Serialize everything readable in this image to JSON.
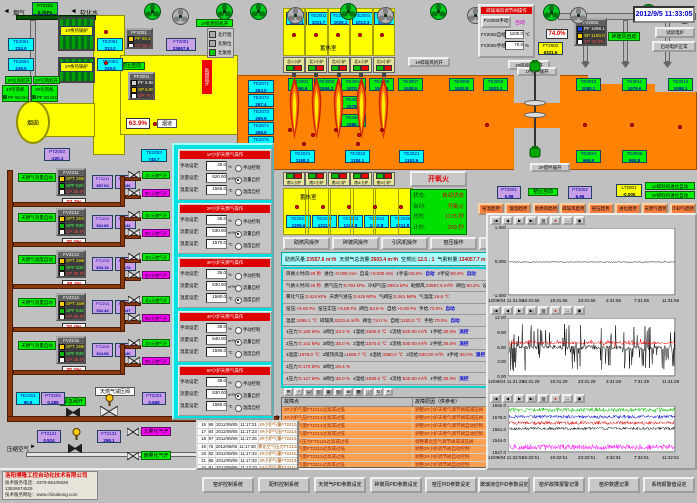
{
  "header": {
    "datetime": "2012/9/5 11:33:05"
  },
  "labels": {
    "flue_gas": "烟气",
    "soft_water": "软化水",
    "chimney": "烟囱",
    "flue": "烟道",
    "comb_air_on": "助燃风开",
    "comb_fan1_on": "1#助燃风机开",
    "idf1_on": "1#引风机开",
    "idf2_on": "2#引风机开",
    "idf1": "1#引风机",
    "idf2": "2#引风机",
    "idf_freq": "PF 50.0Hz",
    "hx1": "1#余热锅炉",
    "hx2": "2#余热锅炉",
    "kiln_auto1": "窑压自动",
    "kiln_auto2": "窑压自动",
    "glass_fan_auto": "碎玻风自动",
    "glass_fan1_on": "1#碎玻风机开",
    "glass_fan2_on": "2#碎玻风机开",
    "stir1_on": "1#搅拌器开",
    "stir2_on": "2#搅拌器开",
    "feeder1_auto": "1#碎料机进位自动",
    "feeder2_auto": "2#碎料机进位自动",
    "test_furnace": "试验电炉",
    "heater_ok": "启动电炉正常",
    "emerg_valve": "紧急阀开",
    "gas_reducer": "天燃气减压阀",
    "comp_air": "压缩空气",
    "atom_north": "北雾化气开",
    "atom_south": "南雾化气开",
    "valve_main": "63.9%",
    "valve_crusher": "74.0%"
  },
  "legend": {
    "items": [
      "北行程",
      "北限位",
      "北氧枪"
    ]
  },
  "furnace": {
    "regen_north": "蓄热室",
    "regen_south": "蓄热室",
    "north_boxes": [
      "北1小炉",
      "北2小炉",
      "北3小炉",
      "北4小炉",
      "北5小炉"
    ],
    "south_boxes": [
      "南1小炉",
      "南2小炉",
      "南3小炉",
      "南4小炉",
      "南5小炉"
    ]
  },
  "sensors": [
    {
      "id": "PT2202",
      "v": "0.7kPa"
    },
    {
      "id": "TE2061",
      "v": "234.0"
    },
    {
      "id": "TE2064",
      "v": "239.0"
    },
    {
      "id": "TE2081",
      "v": "313.0"
    },
    {
      "id": "TE2063",
      "v": "319.0"
    },
    {
      "id": "PT2003",
      "v": "-220.1"
    },
    {
      "id": "TE2053",
      "v": "745.7"
    },
    {
      "id": "FT2001",
      "v": "23657.6"
    },
    {
      "id": "TE2001",
      "v": "1090.1"
    },
    {
      "id": "TE2002",
      "v": "1011.7"
    },
    {
      "id": "TE2003",
      "v": "1025.1"
    },
    {
      "id": "TE2004",
      "v": "1013.3"
    },
    {
      "id": "TE2005",
      "v": "1061.7"
    },
    {
      "id": "TE2071",
      "v": "263.0"
    },
    {
      "id": "TE2072",
      "v": "267.4"
    },
    {
      "id": "TE2073",
      "v": "269.6"
    },
    {
      "id": "TE2074",
      "v": "268.6"
    },
    {
      "id": "TE2075",
      "v": "266.8"
    },
    {
      "id": "TE3001",
      "v": "1550.8"
    },
    {
      "id": "TE3002",
      "v": "1506.2"
    },
    {
      "id": "TE3004",
      "v": "1570.9"
    },
    {
      "id": "TE3022",
      "v": "1578.8"
    },
    {
      "id": "TE3005",
      "v": "1586.7"
    },
    {
      "id": "TE3006",
      "v": "1567.5"
    },
    {
      "id": "TE3007",
      "v": "1538.5"
    },
    {
      "id": "TE3008",
      "v": "1533.8"
    },
    {
      "id": "TE3009",
      "v": "1523.1"
    },
    {
      "id": "TE3010",
      "v": "1080.1"
    },
    {
      "id": "TE3011",
      "v": "1079.6"
    },
    {
      "id": "TE3012",
      "v": "1098.1"
    },
    {
      "id": "TE2021",
      "v": "1168.3"
    },
    {
      "id": "TE3023",
      "v": "1184.1"
    },
    {
      "id": "TE3021",
      "v": "1153.9"
    },
    {
      "id": "TE3024",
      "v": "965.9"
    },
    {
      "id": "TE3025",
      "v": "965.8"
    },
    {
      "id": "TE2041",
      "v": "1209.6"
    },
    {
      "id": "TE2042",
      "v": "1211.0"
    },
    {
      "id": "TE2043",
      "v": "1224.8"
    },
    {
      "id": "TE2044",
      "v": "1212.8"
    },
    {
      "id": "TE2045",
      "v": "1211.8"
    },
    {
      "id": "PT2001",
      "v": "5.88"
    },
    {
      "id": "PT2002",
      "v": "6.96"
    },
    {
      "id": "LT2001",
      "v": "-0.005"
    },
    {
      "id": "FT2002",
      "v": "6331.6"
    },
    {
      "id": "TE2201",
      "v": "90.6"
    },
    {
      "id": "PT2202",
      "v": "0.285"
    },
    {
      "id": "FT2201",
      "v": "0.659"
    },
    {
      "id": "FT2121",
      "v": "0.524"
    },
    {
      "id": "FT2131",
      "v": "298.1"
    }
  ],
  "controllers": {
    "fan": {
      "title": "PF2001",
      "rows": [
        {
          "k": "PF",
          "v": "60.2%"
        },
        {
          "k": "CP",
          "v": "60.1%"
        }
      ]
    },
    "kiln": {
      "title": "PF2001",
      "rows": [
        {
          "k": "PF",
          "v": "5.88"
        },
        {
          "k": "SP",
          "v": "6.00"
        },
        {
          "k": "OP",
          "v": "78.0%"
        }
      ]
    },
    "crusher": {
      "title": "FV2002",
      "rows": [
        {
          "k": "PF",
          "v": "1098.1"
        },
        {
          "k": "SP",
          "v": "1100.0"
        },
        {
          "k": "CP",
          "v": "70.0%"
        }
      ]
    }
  },
  "gas_lines": [
    {
      "fv": "FV2211",
      "auto": "天燃气流量自动",
      "spt": "1560.0",
      "spf": "520.00",
      "cp": "30.0%",
      "ftq_id": "FT2211",
      "ftq": "557.04",
      "ftp_id": "FT2231",
      "ftp": "0.136",
      "valve": "33.3%",
      "north": "北1天燃气开",
      "south": "南1天燃气开"
    },
    {
      "fv": "FV2212",
      "auto": "天燃气流量自动",
      "spt": "1570.0",
      "spf": "530.00",
      "cp": "35.0%",
      "ftq_id": "FT2212",
      "ftq": "522.89",
      "ftp_id": "FT2232",
      "ftp": "0.142",
      "valve": "35.0%",
      "north": "北2天燃气开",
      "south": "南2天燃气开"
    },
    {
      "fv": "FV2213",
      "auto": "天燃气温度自动",
      "spt": "1580.0",
      "spf": "530.00",
      "cp": "35.0%",
      "ftq_id": "FT2213",
      "ftq": "603.19",
      "ftp_id": "FT2233",
      "ftp": "0.178",
      "valve": "48.4%",
      "north": "北3天燃气开",
      "south": "南3天燃气开"
    },
    {
      "fv": "FV2214",
      "auto": "天燃气流量自动",
      "spt": "1590.0",
      "spf": "540.00",
      "cp": "30.0%",
      "ftq_id": "FT2214",
      "ftq": "532.44",
      "ftp_id": "FT2234",
      "ftp": "0.147",
      "valve": "36.0%",
      "north": "北4天燃气开",
      "south": "南4天燃气开"
    },
    {
      "fv": "FV2215",
      "auto": "天燃气流量自动",
      "spt": "1580.0",
      "spf": "530.00",
      "cp": "35.0%",
      "ftq_id": "FT2215",
      "ftq": "524.58",
      "ftp_id": "FT2235",
      "ftp": "0.140",
      "valve": "35.0%",
      "north": "北5天燃气开",
      "south": "南5天燃气开"
    }
  ],
  "popup": {
    "field_labels": [
      "手动设定:",
      "流量设定:",
      "温度设定:"
    ],
    "units": [
      "%",
      "m³/h",
      "℃"
    ],
    "radios": [
      "手动控制",
      "流量自控",
      "温度自控"
    ],
    "panels": [
      {
        "title": "1#小炉天燃气操作",
        "values": [
          "30.0",
          "520.00",
          "1560.0"
        ],
        "selected": 1
      },
      {
        "title": "2#小炉天燃气操作",
        "values": [
          "35.0",
          "530.00",
          "1570.0"
        ],
        "selected": 1
      },
      {
        "title": "3#小炉天燃气操作",
        "values": [
          "35.0",
          "530.00",
          "1580.0"
        ],
        "selected": 2
      },
      {
        "title": "4#小炉天燃气操作",
        "values": [
          "30.0",
          "540.00",
          "1590.0"
        ],
        "selected": 1
      },
      {
        "title": "5#小炉天燃气操作",
        "values": [
          "35.0",
          "530.00",
          "1580.0"
        ],
        "selected": 1
      }
    ]
  },
  "dialog": {
    "title": "碎玻璃风调节阀操作",
    "manual_btn": "FV2002手动",
    "auto_label": "自动",
    "rows": [
      {
        "l": "FV2002自给",
        "v": "1100.0",
        "u": "℃"
      },
      {
        "l": "FV2002手给",
        "v": "70.0",
        "u": "%"
      }
    ]
  },
  "status_panel": {
    "fire_btn": "开氧火",
    "rows": [
      {
        "l": "状态:",
        "v": "自动状态"
      },
      {
        "l": "自动:",
        "v": "开氧火"
      },
      {
        "l": "总时:",
        "v": "1175 秒"
      },
      {
        "l": "计时:",
        "v": "269 秒"
      }
    ]
  },
  "op_buttons": [
    "助燃风操作",
    "碎玻风操作",
    "引风机操作",
    "窑压操作",
    "进位操作",
    "天燃气操作"
  ],
  "trend_buttons": [
    "窑温趋势",
    "烟温趋势",
    "助燃风趋势",
    "碎玻风趋势",
    "窑压趋势",
    "进位趋势",
    "天燃气趋势",
    "冷却气趋势"
  ],
  "summary": [
    {
      "l": "助燃风量:",
      "v": "23557.6 m³/h"
    },
    {
      "l": "天燃气总流量:",
      "v": "2603.4 m³/h"
    },
    {
      "l": "空燃比:",
      "v": "12.5 : 1"
    },
    {
      "l": "气累积量:",
      "v": "134057.7 m³"
    }
  ],
  "param_rows": [
    [
      {
        "l": "风换火时间:",
        "v": "25 秒"
      },
      {
        "l": "进位:",
        "v": "-0.005 mm"
      },
      {
        "l": "自设:",
        "v": "+0.000 mm"
      },
      {
        "l": "1手设:",
        "v": "50.0%"
      },
      {
        "tag": "自动"
      },
      {
        "l": "2手设:",
        "v": "50.0%"
      },
      {
        "tag": "自动"
      }
    ],
    [
      {
        "l": "气换火时间:",
        "v": "25 秒"
      },
      {
        "l": "燃气压力:",
        "v": "0.794 kPa"
      },
      {
        "l": "冷却气压:",
        "v": "298.5 kPa"
      },
      {
        "l": "助燃风:",
        "v": "23557.6 m³/h"
      },
      {
        "l": "阀位:",
        "v": "60.2%"
      },
      {
        "l": "设定:",
        "v": "60.0%"
      }
    ],
    [
      {
        "l": "雾化气压:",
        "v": "0.524 kPa"
      },
      {
        "l": "天燃气进压:",
        "v": "0.619 MPa"
      },
      {
        "l": "气阀压:",
        "v": "0.261 MPa"
      },
      {
        "l": "气温度:",
        "v": "19.6 ℃"
      }
    ],
    [
      {
        "l": "窑压:",
        "v": "+6.00 Pa"
      },
      {
        "l": "窑压实压:",
        "v": "+5.88 Pa"
      },
      {
        "l": "阀位:",
        "v": "63.9 %"
      },
      {
        "l": "自给:",
        "v": "+6.00 Pa"
      },
      {
        "l": "手给:",
        "v": "70.0%"
      },
      {
        "tag": "自动"
      }
    ],
    [
      {
        "l": "温度:",
        "v": "1098.1 ℃"
      },
      {
        "l": "碎玻风:",
        "v": "6331.6 m³/h"
      },
      {
        "l": "阀位:",
        "v": "74.0 %"
      },
      {
        "l": "自给:",
        "v": "1100.0 ℃"
      },
      {
        "l": "手给:",
        "v": "70.0%"
      },
      {
        "tag": "自动"
      }
    ],
    [
      {
        "l": "1压力:",
        "v": "0.138 kPa"
      },
      {
        "l": "1阀位:",
        "v": "33.3 %"
      },
      {
        "l": "1温给:",
        "v": "1560.0 ℃"
      },
      {
        "l": "1流给:",
        "v": "520.00 m³/h"
      },
      {
        "l": "1手给:",
        "v": "30.0%"
      },
      {
        "tag": "流控"
      }
    ],
    [
      {
        "l": "2压力:",
        "v": "0.142 kPa"
      },
      {
        "l": "2阀位:",
        "v": "35.0 %"
      },
      {
        "l": "2温给:",
        "v": "1570.0 ℃"
      },
      {
        "l": "2流给:",
        "v": "530.00 m³/h"
      },
      {
        "l": "2手给:",
        "v": "35.0%"
      },
      {
        "tag": "流控"
      }
    ],
    [
      {
        "l": "3温度:",
        "v": "1578.0 ℃"
      },
      {
        "l": "3玻顶高温=",
        "v": "1586.7 ℃"
      },
      {
        "l": "3温给:",
        "v": "1580.0 ℃"
      },
      {
        "l": "3流给:",
        "v": "530.00 m³/h"
      },
      {
        "l": "3手给:",
        "v": "35.0%"
      },
      {
        "tag": "温控"
      }
    ],
    [
      {
        "l": "3压力:",
        "v": "0.178 kPa"
      },
      {
        "l": "3阀位:",
        "v": "48.4 %"
      }
    ],
    [
      {
        "l": "4压力:",
        "v": "0.147 kPa"
      },
      {
        "l": "4阀位:",
        "v": "36.0 %"
      },
      {
        "l": "4温给:",
        "v": "1590.0 ℃"
      },
      {
        "l": "4流给:",
        "v": "540.00 m³/h"
      },
      {
        "l": "4手给:",
        "v": "30.0%"
      },
      {
        "tag": "流控"
      }
    ],
    [
      {
        "l": "5压力:",
        "v": "0.140 kPa"
      },
      {
        "l": "5阀位:",
        "v": "35.0 %"
      },
      {
        "l": "5温给:",
        "v": "1580.0 ℃"
      },
      {
        "l": "5流给:",
        "v": "530.00 m³/h"
      },
      {
        "l": "5手给:",
        "v": "35.0%"
      },
      {
        "tag": "流控"
      }
    ]
  ],
  "toolbar_icons": [
    "≣",
    "?",
    "▤",
    "▥",
    "▦",
    "▧",
    "⊞",
    "▩",
    "◫",
    "⇅",
    "×"
  ],
  "chart_toolbar": [
    "|◀",
    "◀",
    "▶",
    "▶|",
    "▧",
    "●",
    "↔",
    "▣"
  ],
  "alarm_table": {
    "headers": [
      "故障点",
      "故障原因（供参考）"
    ],
    "rows": [
      [
        "2#小炉气量FT2212过高或过低",
        "调整2#小炉天燃气调节阀或减压阀"
      ],
      [
        "4#小炉气压FT2214过高或过低",
        "调整4#小炉天燃气调节阀或减压阀"
      ],
      [
        "4#小炉气量FT2214过高或过低",
        "调整4#小炉天燃气调节阀自动控制"
      ],
      [
        "3#小炉气量FT2213过高或过低",
        "调整3#小炉天燃气调节阀自动控制"
      ],
      [
        "雾化空气压力FT2122过高或过低",
        "调整雾化空气调节阀或减压阀"
      ],
      [
        "2#小炉气量FT2212过高或过低",
        "调整2#小炉调节阀自动控制"
      ],
      [
        "3#小炉气量FT2213过高或过低",
        "调整3#小炉调节阀自动控制"
      ],
      [
        "1#小炉气量FT2211过高或过低",
        "调整1#小炉调节阀自动控制"
      ],
      [
        "1#小炉气压FT2211过高或过低",
        "调整1#小炉调节阀自动控制"
      ]
    ]
  },
  "log_table": {
    "rows": [
      [
        "16",
        "98",
        "2012/09/05",
        "11:17:21",
        "2#小炉气量FT2212过高或过低"
      ],
      [
        "17",
        "84",
        "2012/09/05",
        "11:17:23",
        "4#小炉气压FT2214过高或过低"
      ],
      [
        "18",
        "97",
        "2012/09/05",
        "11:17:26",
        "3#小炉气量FT2213过高或过低"
      ],
      [
        "19",
        "75",
        "2012/09/05",
        "11:17:30",
        "雾化空气压力FT2122过高或过低"
      ],
      [
        "20",
        "82",
        "2012/09/05",
        "11:17:33",
        "2#小炉气量FT2212过高或过低"
      ],
      [
        "21",
        "85",
        "2012/09/05",
        "11:17:33",
        "3#小炉气量FT2213过高或过低"
      ],
      [
        "22",
        "81",
        "2012/09/05",
        "11:17:33",
        "1#小炉气量FT2211过高或过低"
      ],
      [
        "23",
        "83",
        "2012/09/05",
        "11:17:33",
        "2#小炉气量FT2212过高或过低"
      ]
    ],
    "selected": "23"
  },
  "bottom_buttons": [
    "窑炉控制系统",
    "配料控制系统",
    "天燃气PID参数设定",
    "碎玻风PID参数设定",
    "窑压PID参数设定",
    "玻璃液位PID参数设定",
    "窑炉故障报警记录",
    "窑炉数据记录",
    "系统报警值设定"
  ],
  "company": {
    "name": "洛阳博隆工控自动化技术有限公司",
    "phone": "技术服务电话：0379-65105829  13526974529",
    "web": "技术服务网址：www.chinakong.com"
  },
  "chart_data": [
    {
      "type": "line",
      "title": "进位趋势",
      "yticks": [
        "1.000",
        "0.000",
        "-1.000"
      ],
      "ylim": [
        -1,
        1
      ],
      "xticks": [
        "12/09/04 11:31:56",
        "15:31:56",
        "19:31:56",
        "23:31:56",
        "3:31:56",
        "7:31:56",
        "11:31:56"
      ],
      "series": [
        {
          "name": "black",
          "color": "#000000",
          "base": 0.0,
          "amp": 0.015,
          "spike": 0,
          "spike_p": 0
        }
      ]
    },
    {
      "type": "line",
      "title": "窑压趋势",
      "yticks": [
        "12.00",
        "9.00",
        "6.00",
        "3.00",
        "0.00"
      ],
      "ylim": [
        0,
        12
      ],
      "xticks": [
        "12/09/04 11:31:29",
        "15:31:29",
        "19:31:29",
        "23:31:29",
        "3:31:29",
        "7:31:29",
        "11:31:29"
      ],
      "series": [
        {
          "name": "black",
          "color": "#000000",
          "base": 6.0,
          "amp": 0.4,
          "spike": 5,
          "spike_p": 0.3
        },
        {
          "name": "red",
          "color": "#ff0000",
          "base": 7.0,
          "amp": 0.3,
          "spike": 0.8,
          "spike_p": 0.1
        }
      ]
    },
    {
      "type": "line",
      "title": "窑温趋势",
      "yticks": [
        "1592.0",
        "1578.0",
        "1561.0",
        "1544.0",
        "1527.0"
      ],
      "ylim": [
        1527,
        1592
      ],
      "xticks": [
        "12/09/04 11:32:51",
        "15:32:51",
        "19:32:51",
        "23:32:51",
        "3:32:51",
        "7:32:51",
        "11:32:51"
      ],
      "series": [
        {
          "name": "green",
          "color": "#00bb00",
          "base": 1588,
          "amp": 3,
          "spike": 2,
          "spike_p": 0.2
        },
        {
          "name": "blue",
          "color": "#0000cc",
          "base": 1578,
          "amp": 2.5,
          "spike": 2,
          "spike_p": 0.2
        },
        {
          "name": "red",
          "color": "#dd0000",
          "base": 1569,
          "amp": 2.5,
          "spike": 2,
          "spike_p": 0.2
        },
        {
          "name": "black",
          "color": "#000000",
          "base": 1561,
          "amp": 2,
          "spike": 2,
          "spike_p": 0.2
        },
        {
          "name": "magenta",
          "color": "#ff00ff",
          "base": 1534,
          "amp": 4,
          "spike": 3,
          "spike_p": 0.25
        }
      ]
    }
  ]
}
